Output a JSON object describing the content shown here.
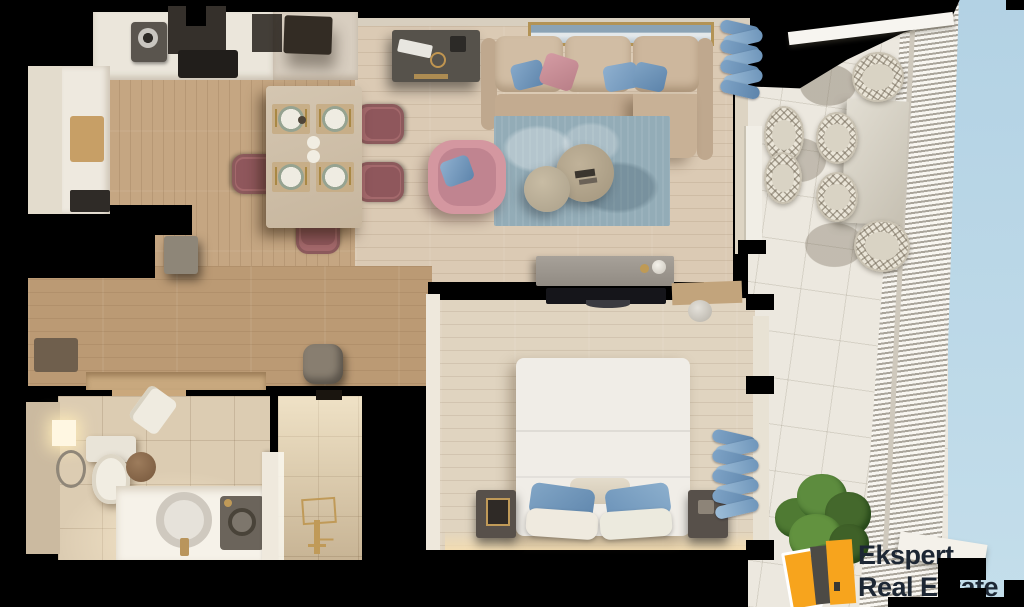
{
  "image": {
    "width": 1024,
    "height": 607,
    "background": "#000000",
    "description": "3D top-down render of a one-bedroom apartment floor plan with furnished balcony"
  },
  "branding": {
    "line1": "Ekspert",
    "line2": "Real Estate",
    "text_color": "#1d2734",
    "icon": {
      "primary": "#f7a41d",
      "dark": "#4c4a45",
      "outline": "#ffffff"
    }
  },
  "palette": {
    "kitchen_floor": "#c5a682",
    "living_floor": "#dbcab4",
    "hall_floor": "#bb9a74",
    "bedroom_floor": "#e0d4c0",
    "counter_white": "#ebe6db",
    "counter_beige": "#d8cec0",
    "sofa_beige": "#cdb79d",
    "rug_blue": "#93acb7",
    "accent_blue": "#6e93b6",
    "accent_pink": "#c98d95",
    "dining_chair_pink": "#a4696c",
    "bed_white": "#f0ede7",
    "curtain_blue": "#7ba0c4",
    "balcony_floor": "#ece8df",
    "sky_blue": "#b9d6e7",
    "plant_green": "#5d8c3e",
    "walls": "#000000"
  },
  "rooms": [
    {
      "name": "kitchen",
      "items": [
        "upper-counter",
        "coffee-machine",
        "extractor-hood",
        "cooktop",
        "dark-appliance",
        "side-counter",
        "cutting-board",
        "fridge-cabinet"
      ]
    },
    {
      "name": "dining-area",
      "items": [
        "stone-dining-table",
        "place-setting-1",
        "place-setting-2",
        "place-setting-3",
        "place-setting-4",
        "dining-chair-right-top",
        "dining-chair-right-bottom",
        "dining-chair-left",
        "dining-chair-bottom",
        "salt-pepper-set"
      ]
    },
    {
      "name": "living-room",
      "items": [
        "desk",
        "keyboard",
        "seascape-artwork",
        "l-shaped-sofa",
        "blue-cushions",
        "pink-cushion",
        "area-rug",
        "coffee-table-large",
        "coffee-table-small",
        "pink-armchair",
        "tv-console",
        "vase",
        "blue-curtains"
      ]
    },
    {
      "name": "hallway",
      "items": [
        "pouf",
        "entry-mat",
        "shoe-shelf"
      ]
    },
    {
      "name": "bedroom",
      "items": [
        "double-bed",
        "blue-pillows",
        "white-pillows",
        "nightstand-left",
        "nightstand-right",
        "table-lamp",
        "wall-tv",
        "dresser",
        "blue-curtains"
      ]
    },
    {
      "name": "bathroom",
      "items": [
        "toilet",
        "towel-ring",
        "wall-light",
        "laundry-basket",
        "hanging-towel",
        "vanity-counter",
        "round-sink",
        "gold-faucet",
        "washing-machine"
      ]
    },
    {
      "name": "shower-room",
      "items": [
        "walk-in-shower",
        "gold-shower-set",
        "glass-partition"
      ]
    },
    {
      "name": "balcony",
      "items": [
        "outdoor-stone-table",
        "wicker-chair-1",
        "wicker-chair-2",
        "wicker-chair-3",
        "wicker-chair-4",
        "wicker-chair-5",
        "wicker-chair-6",
        "slatted-railing",
        "potted-plant",
        "sky-view"
      ]
    }
  ]
}
